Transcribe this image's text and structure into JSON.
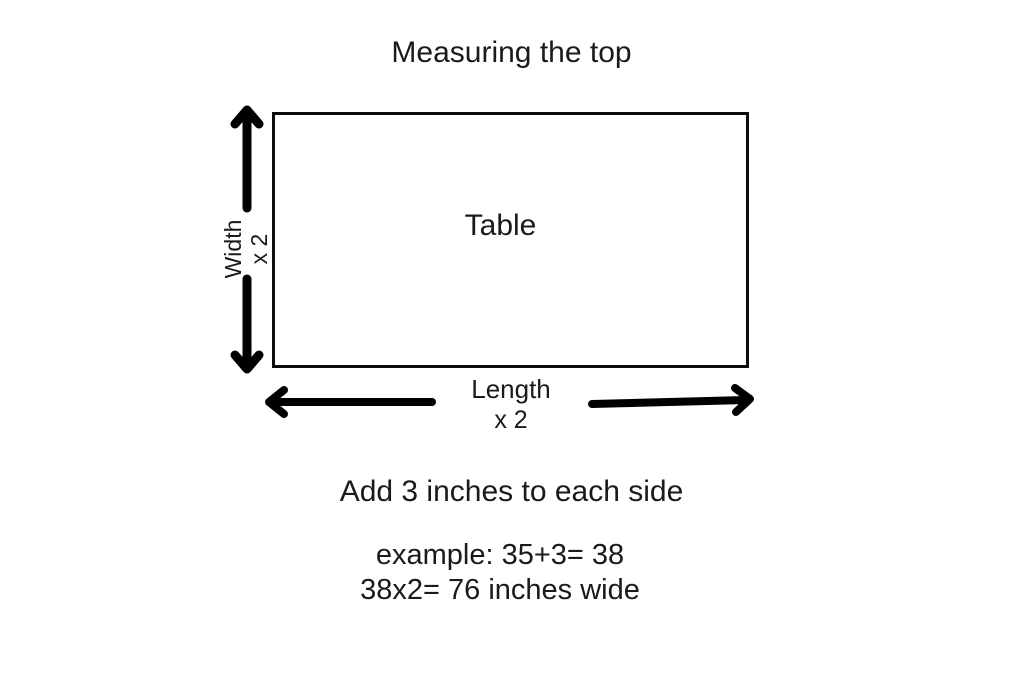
{
  "title": "Measuring the top",
  "diagram": {
    "table_label": "Table",
    "width_label": {
      "word": "Width",
      "multiplier": "x 2"
    },
    "length_label": {
      "word": "Length",
      "multiplier": "x 2"
    }
  },
  "instructions": {
    "add_note": "Add 3 inches to each side",
    "example_line1": "example: 35+3= 38",
    "example_line2": "38x2= 76 inches wide"
  },
  "colors": {
    "background": "#ffffff",
    "ink": "#000000",
    "text": "#1a1a1a"
  }
}
